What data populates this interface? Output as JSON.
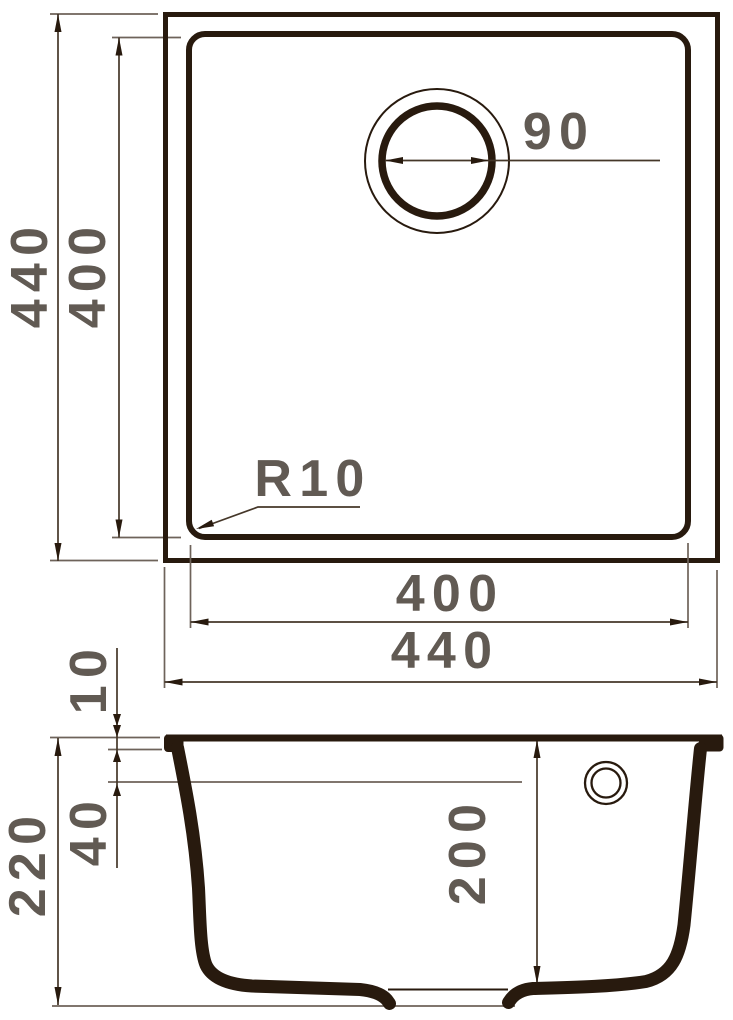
{
  "colors": {
    "line": "#281a0e",
    "dim": "#453729",
    "ext": "#6e635a",
    "text": "#615a53",
    "background": "#ffffff"
  },
  "labels": {
    "top_outer_height": "440",
    "top_inner_height": "400",
    "top_inner_width": "400",
    "top_outer_width": "440",
    "drain_diameter": "90",
    "corner_radius": "R10",
    "rim_thickness": "10",
    "step_depth": "40",
    "overall_height": "220",
    "bowl_depth": "200"
  }
}
